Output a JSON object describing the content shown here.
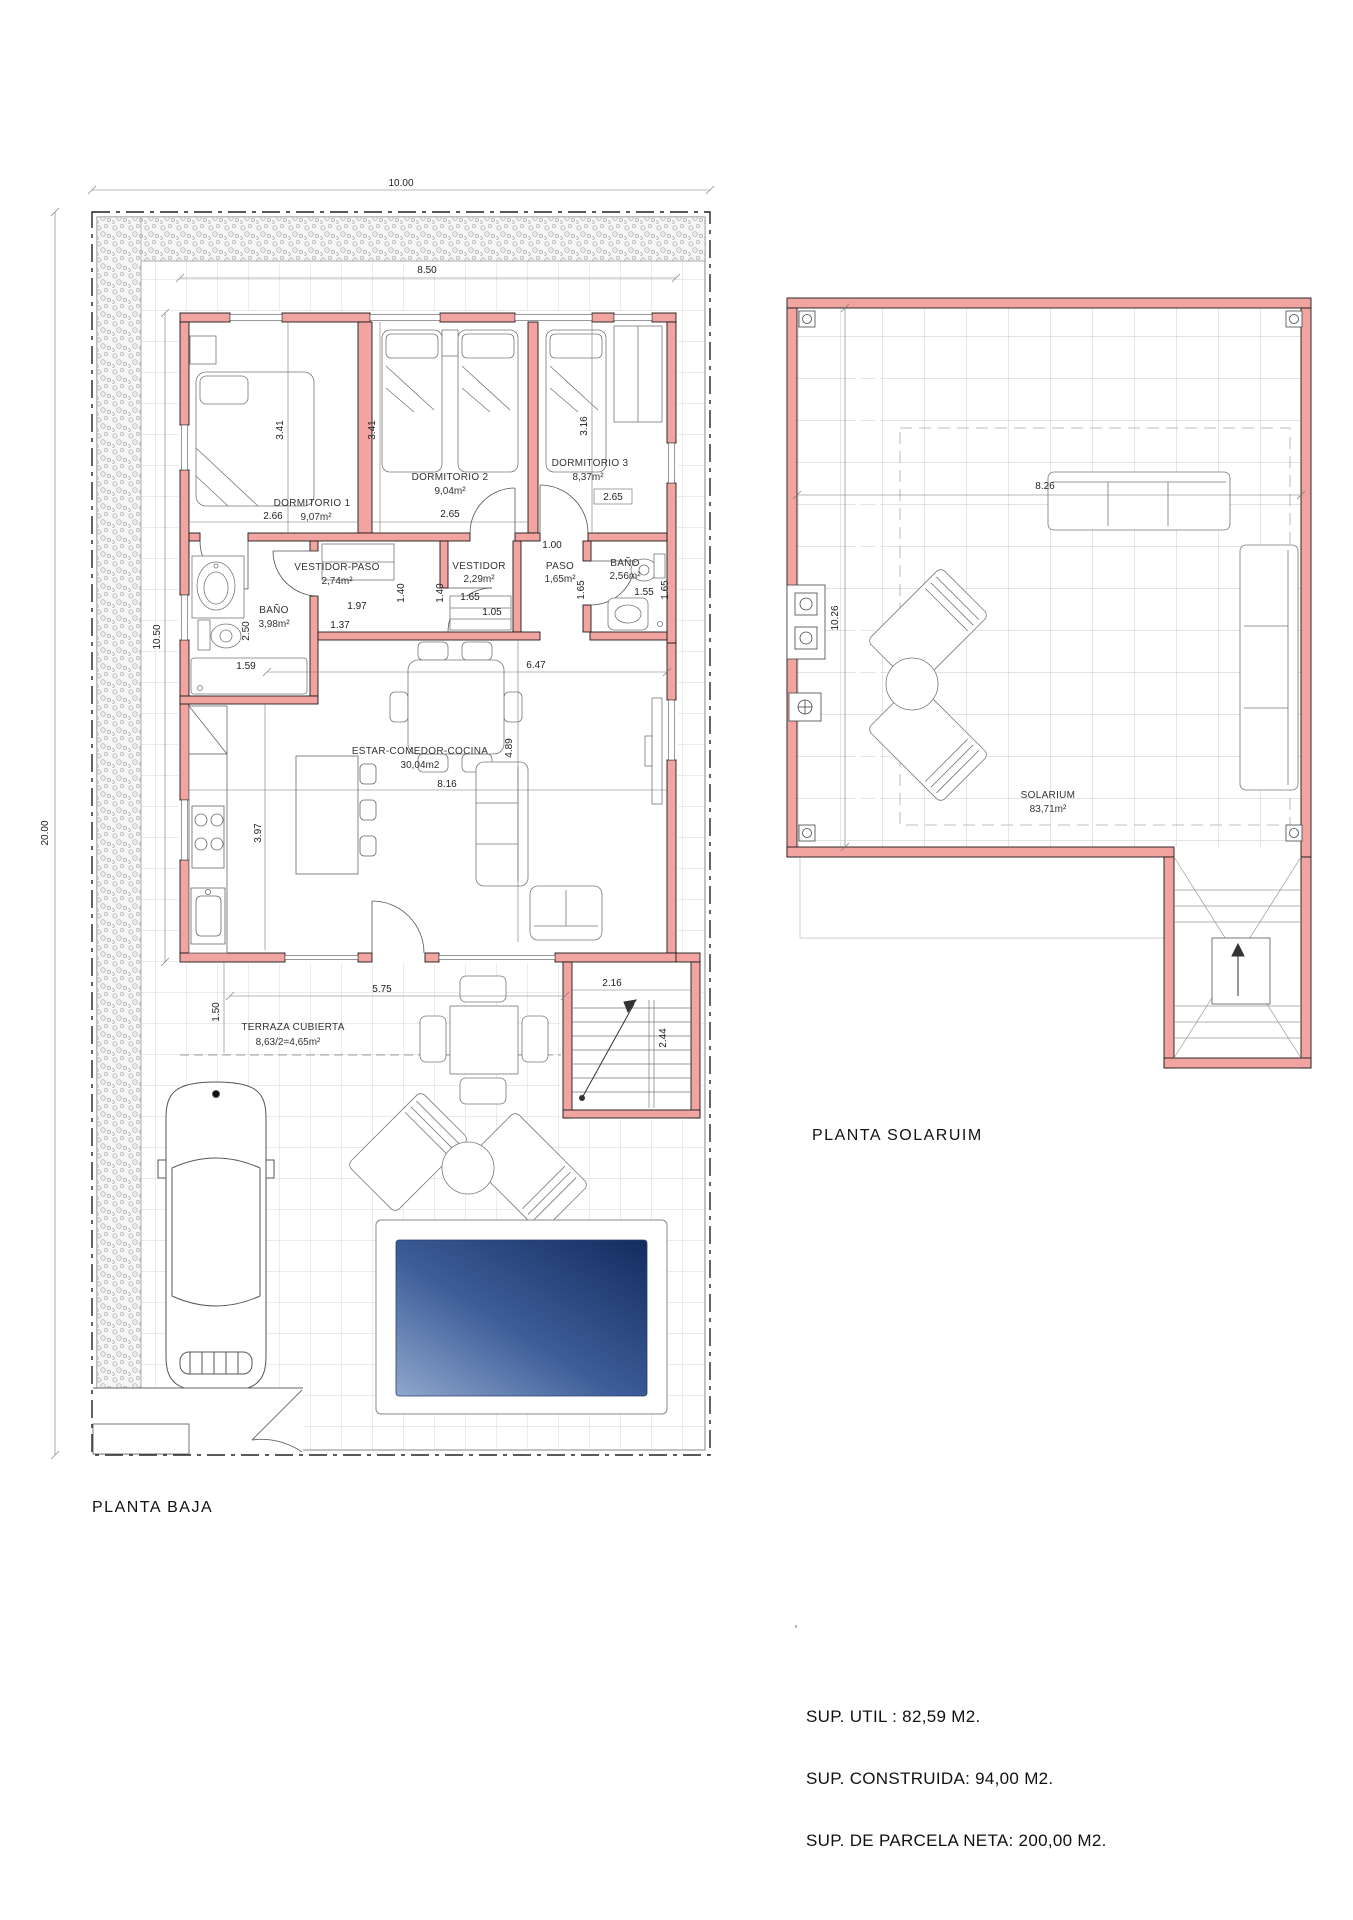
{
  "planta_baja": {
    "title": "PLANTA BAJA",
    "rooms": {
      "dorm1": {
        "name": "DORMITORIO 1",
        "area": "9,07m²"
      },
      "dorm2": {
        "name": "DORMITORIO 2",
        "area": "9,04m²"
      },
      "dorm3": {
        "name": "DORMITORIO 3",
        "area": "8,37m²"
      },
      "bano1": {
        "name": "BAÑO",
        "area": "3,98m²"
      },
      "vestidor_paso": {
        "name": "VESTIDOR-PASO",
        "area": "2,74m²"
      },
      "vestidor": {
        "name": "VESTIDOR",
        "area": "2,29m²"
      },
      "paso": {
        "name": "PASO",
        "area": "1,65m²"
      },
      "bano2": {
        "name": "BAÑO",
        "area": "2,56m²"
      },
      "estar": {
        "name": "ESTAR-COMEDOR-COCINA",
        "area": "30,04m2"
      },
      "terraza": {
        "name": "TERRAZA CUBIERTA",
        "area": "8,63/2=4,65m²"
      }
    },
    "dims": {
      "parcel_w": "10.00",
      "parcel_h": "20.00",
      "top_int": "8.50",
      "house_h": "10.50",
      "d1_h": "3.41",
      "d2_h": "3.41",
      "d3_h": "3.16",
      "d1_w": "2.66",
      "d2_w": "2.65",
      "d3_w": "2.65",
      "paso_top": "1.00",
      "vp_a": "1.97",
      "vp_b": "1.37",
      "vp_h": "1.40",
      "vest_h": "1.40",
      "bano1_h": "2.50",
      "bano1_w": "1.59",
      "vest_a": "1.65",
      "vest_b": "1.05",
      "paso_h": "1.65",
      "bano2_w": "1.55",
      "bano2_h": "1.65",
      "hall": "6.47",
      "liv_w": "8.16",
      "liv_h": "3.97",
      "liv_h2": "4.89",
      "terr_w": "5.75",
      "terr_h": "1.50",
      "st_w": "2.16",
      "st_h": "2.44"
    }
  },
  "planta_solarium": {
    "title": "PLANTA SOLARUIM",
    "room": {
      "name": "SOLARIUM",
      "area": "83,71m²"
    },
    "dims": {
      "w": "8.26",
      "h": "10.26"
    }
  },
  "summary": {
    "util": "SUP. UTIL : 82,59 M2.",
    "construida": "SUP. CONSTRUIDA: 94,00 M2.",
    "parcela": "SUP. DE PARCELA NETA: 200,00 M2."
  },
  "misc": {
    "stray_mark": "‘"
  },
  "colors": {
    "wall": "#F2A4A0",
    "pool_dark": "#132C5E",
    "pool_light": "#8FA7CC"
  }
}
